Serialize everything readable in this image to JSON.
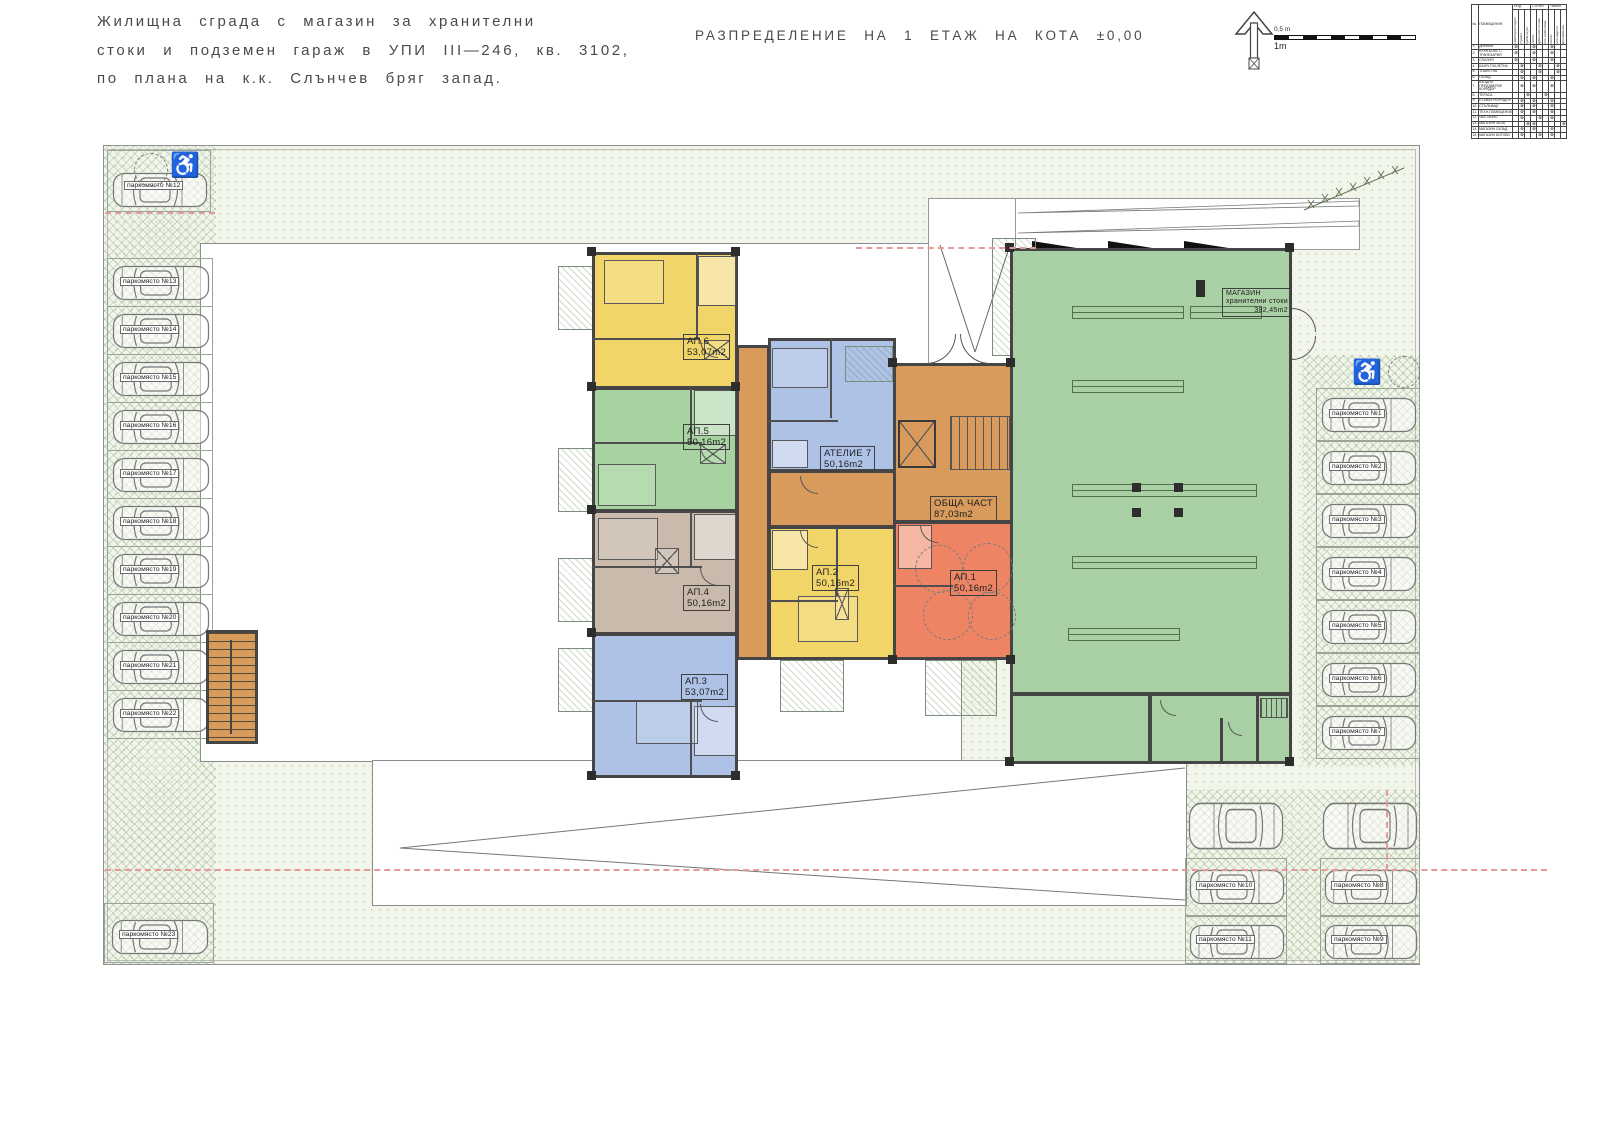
{
  "title_block": {
    "line1": "Жилищна сграда с магазин за хранителни",
    "line2": "стоки и подземен гараж в УПИ III—246, кв. 3102,",
    "line3": "по плана на к.к. Слънчев бряг запад."
  },
  "drawing_title": "РАЗПРЕДЕЛЕНИЕ НА 1 ЕТАЖ НА КОТА ±0,00",
  "scale_bar": {
    "label_top": "0,5 m",
    "label_bottom": "1m"
  },
  "legend_table": {
    "headers": {
      "num": "№",
      "room": "ПОМЕЩЕНИЯ",
      "floor": "ПОД",
      "walls": "СТЕНИ",
      "ceiling": "ТАВАН"
    },
    "sub_headers": [
      "ламиниран паркет",
      "теракот",
      "гранитогрес",
      "латекс",
      "фаянсови плочки",
      "гипс.шпакловка",
      "латекс",
      "гипсокартон",
      "мин.мазилка"
    ],
    "rows": [
      {
        "n": "1.",
        "name": "ДНЕВНА",
        "marks": [
          0,
          3,
          6
        ]
      },
      {
        "n": "2.",
        "name": "КУХН.БОКС С ТРАПЕЗАРИЯ",
        "marks": [
          0,
          3,
          6
        ]
      },
      {
        "n": "3.",
        "name": "СПАЛНЯ",
        "marks": [
          0,
          3,
          6
        ]
      },
      {
        "n": "4.",
        "name": "БАНЯ-ТОАЛЕТНА",
        "marks": [
          1,
          4,
          7
        ]
      },
      {
        "n": "5.",
        "name": "ТОАЛЕТНА",
        "marks": [
          1,
          4,
          7
        ]
      },
      {
        "n": "6.",
        "name": "СКЛАД",
        "marks": [
          1,
          3,
          6
        ]
      },
      {
        "n": "7.",
        "name": "ВХОДНО ПРЕДДВЕРИЕ КОРИДОР",
        "marks": [
          1,
          3,
          6
        ]
      },
      {
        "n": "8.",
        "name": "ТЕРАСА",
        "marks": [
          2,
          5
        ]
      },
      {
        "n": "9.",
        "name": "ЕТАЖЕН КОРИДОР",
        "marks": [
          1,
          3,
          6
        ]
      },
      {
        "n": "10.",
        "name": "СТЪЛБИЩЕ",
        "marks": [
          1,
          3,
          6
        ]
      },
      {
        "n": "11.",
        "name": "ТЕХН.ПОМЕЩЕНИЕ",
        "marks": [
          1,
          3,
          6
        ]
      },
      {
        "n": "12.",
        "name": "ЧИСТАЧНО",
        "marks": [
          1,
          4,
          6
        ]
      },
      {
        "n": "13.",
        "name": "МАГАЗИН ЗАЛА",
        "marks": [
          2,
          3,
          8
        ]
      },
      {
        "n": "14.",
        "name": "МАГАЗИН СКЛАД",
        "marks": [
          1,
          3,
          6
        ]
      },
      {
        "n": "15.",
        "name": "МАГАЗИН БИТОВО",
        "marks": [
          1,
          4,
          6
        ]
      }
    ]
  },
  "apartments": {
    "ap1": {
      "label": "АП.1",
      "area": "50,16m2"
    },
    "ap2": {
      "label": "АП.2",
      "area": "50,16m2"
    },
    "ap3": {
      "label": "АП.3",
      "area": "53,07m2"
    },
    "ap4": {
      "label": "АП.4",
      "area": "50,16m2"
    },
    "ap5": {
      "label": "АП.5",
      "area": "50,16m2"
    },
    "ap6": {
      "label": "АП.6",
      "area": "53,07m2"
    },
    "atelier": {
      "label": "АТЕЛИЕ 7",
      "area": "50,16m2"
    }
  },
  "common_area": {
    "label": "ОБЩА ЧАСТ",
    "area": "87,03m2"
  },
  "shop": {
    "label": "МАГАЗИН",
    "subtitle": "хранителни стоки",
    "area": "382,45m2"
  },
  "parking": {
    "left": [
      {
        "label": "паркомясто №12"
      },
      {
        "label": "паркомясто №13"
      },
      {
        "label": "паркомясто №14"
      },
      {
        "label": "паркомясто №15"
      },
      {
        "label": "паркомясто №16"
      },
      {
        "label": "паркомясто №17"
      },
      {
        "label": "паркомясто №18"
      },
      {
        "label": "паркомясто №19"
      },
      {
        "label": "паркомясто №20"
      },
      {
        "label": "паркомясто №21"
      },
      {
        "label": "паркомясто №22"
      },
      {
        "label": "паркомясто №23"
      }
    ],
    "right": [
      {
        "label": "паркомясто №1"
      },
      {
        "label": "паркомясто №2"
      },
      {
        "label": "паркомясто №3"
      },
      {
        "label": "паркомясто №4"
      },
      {
        "label": "паркомясто №5"
      },
      {
        "label": "паркомясто №6"
      },
      {
        "label": "паркомясто №7"
      }
    ],
    "bottom": [
      {
        "label": "паркомясто №10"
      },
      {
        "label": "паркомясто №8"
      },
      {
        "label": "паркомясто №11"
      },
      {
        "label": "паркомясто №9"
      }
    ]
  },
  "colors": {
    "yellow": "#F2D568",
    "green": "#A6D3A0",
    "taupe": "#C9BAAB",
    "blue": "#AEC2E8",
    "orange": "#D89B5B",
    "red": "#EF8465",
    "shop_green": "#A9CFA4",
    "site_bg": "#F2F5EA",
    "wall": "#454545",
    "red_dash": "#E59A9A"
  }
}
